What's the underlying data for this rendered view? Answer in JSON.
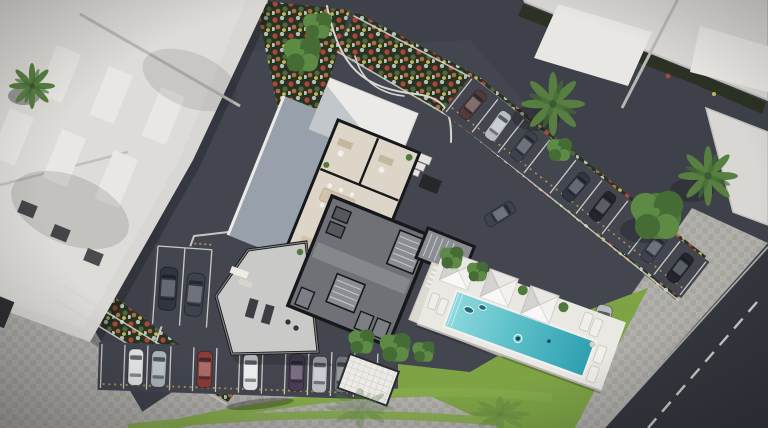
{
  "scene": {
    "type": "3d-aerial-architectural-render",
    "description": "Top-down aerial 3D rendering of a residential project site: a cutaway ground-floor plan of the main building showing offices, meeting tables, a lounge, a gym and dark stair/elevator cores; a white pool deck with a rectangular turquoise lap pool and three white pyramid canopies; angled parking rows filled with cars; lawns, curved grass bands, flower beds, palm trees; and white neighboring rooftops with skylights."
  },
  "palette": {
    "asphalt": "#3e414a",
    "asphaltLight": "#474a53",
    "spotAsphalt": "#43464f",
    "road": "#34373e",
    "paver": "#a7a5a0",
    "paverLight": "#b1afaa",
    "curb": "#d6d5d1",
    "roadLine": "#cfcfcc",
    "roofWhite": "#d9d7d3",
    "roofInner": "#dedcd8",
    "roofPanel": "#e9e7e3",
    "roofEdge": "#c2c0bc",
    "roofShade": "#b9b7b3",
    "hedge": "#2b3124",
    "bedSoil": "#283321",
    "flowerRed": "#a8473a",
    "flowerWhite": "#b9bdb4",
    "flowerOrange": "#b06a3f",
    "flowerYellow": "#c9b559",
    "flowerGreen": "#50663c",
    "grass": "#7da345",
    "grassArc": "#84a94a",
    "treeDark": "#446c34",
    "treeMid": "#4f7a3c",
    "treeLight": "#5d8a45",
    "palmGreen": "#587f41",
    "palmCore": "#3e5a33",
    "planFloor": "#ddd6c8",
    "planWall": "#17181b",
    "planGray": "#6f7176",
    "planGrayLight": "#8b8d92",
    "planGrayDark": "#55575c",
    "gymFloor": "#c9c9c8",
    "slateRoof": "#97a0ab",
    "whiteRoof": "#eceae6",
    "terraceFloor": "#ddd8d0",
    "wood": "#b06a42",
    "woodDark": "#8f4f34",
    "tableTan": "#cfc3ab",
    "deck": "#eae8e3",
    "poolShallow": "#8ed9dd",
    "poolDeep": "#2e9fb0",
    "canopyWhite": "#f2f1ee",
    "carWhite": "#e6e7e8",
    "carSilver": "#b8bcc2",
    "carSilverBlue": "#aeb6bf",
    "carGray": "#70737a",
    "carDark": "#3d424c",
    "carNavy": "#2f3541",
    "carBlack": "#23262c",
    "carRed": "#8e3b35",
    "carPurple": "#4b3c55",
    "carMaroon": "#553a3c",
    "stopYellow": "#c49a52",
    "shadow": "#15171b"
  },
  "main_building": {
    "rooms": [
      "private offices",
      "open work area",
      "meeting tables",
      "lounge",
      "gym",
      "stair cores",
      "elevators",
      "storage",
      "covered terrace"
    ],
    "features": [
      "white entrance roof",
      "stepped side entry",
      "pergola courtyard",
      "slate roof band"
    ]
  },
  "pool_area": {
    "pool": "rectangular lap pool",
    "canopies": 3,
    "sun_loungers": 6,
    "planters": 3,
    "swimmers": 2,
    "floats": 2
  },
  "parking": {
    "northeast_row": {
      "spots": 9,
      "cars": [
        "maroon",
        "silver",
        "dark-gray",
        null,
        "navy",
        "black",
        null,
        "dark-gray",
        "black"
      ]
    },
    "south_row": {
      "spots": 12,
      "cars": [
        null,
        "white",
        "silver-blue",
        null,
        "red",
        null,
        "white",
        null,
        "purple",
        "silver",
        "gray",
        null
      ]
    },
    "west_row": {
      "spots": 3,
      "cars": [
        "navy",
        "dark-gray",
        null
      ]
    },
    "standalone_cars": [
      "silver car beside lawn",
      "dark car beside terrace"
    ]
  },
  "landscaping": {
    "palm_trees": 4,
    "leafy_trees": 9,
    "flower_beds": 4,
    "lawns": 2,
    "grass_arcs": 2,
    "hedge_strips": 1
  },
  "neighbors": {
    "northwest_roof_skylights": 6,
    "northwest_roof_vents": 3,
    "northeast_roofs": 2
  },
  "road": {
    "dashed_center_line": true
  }
}
